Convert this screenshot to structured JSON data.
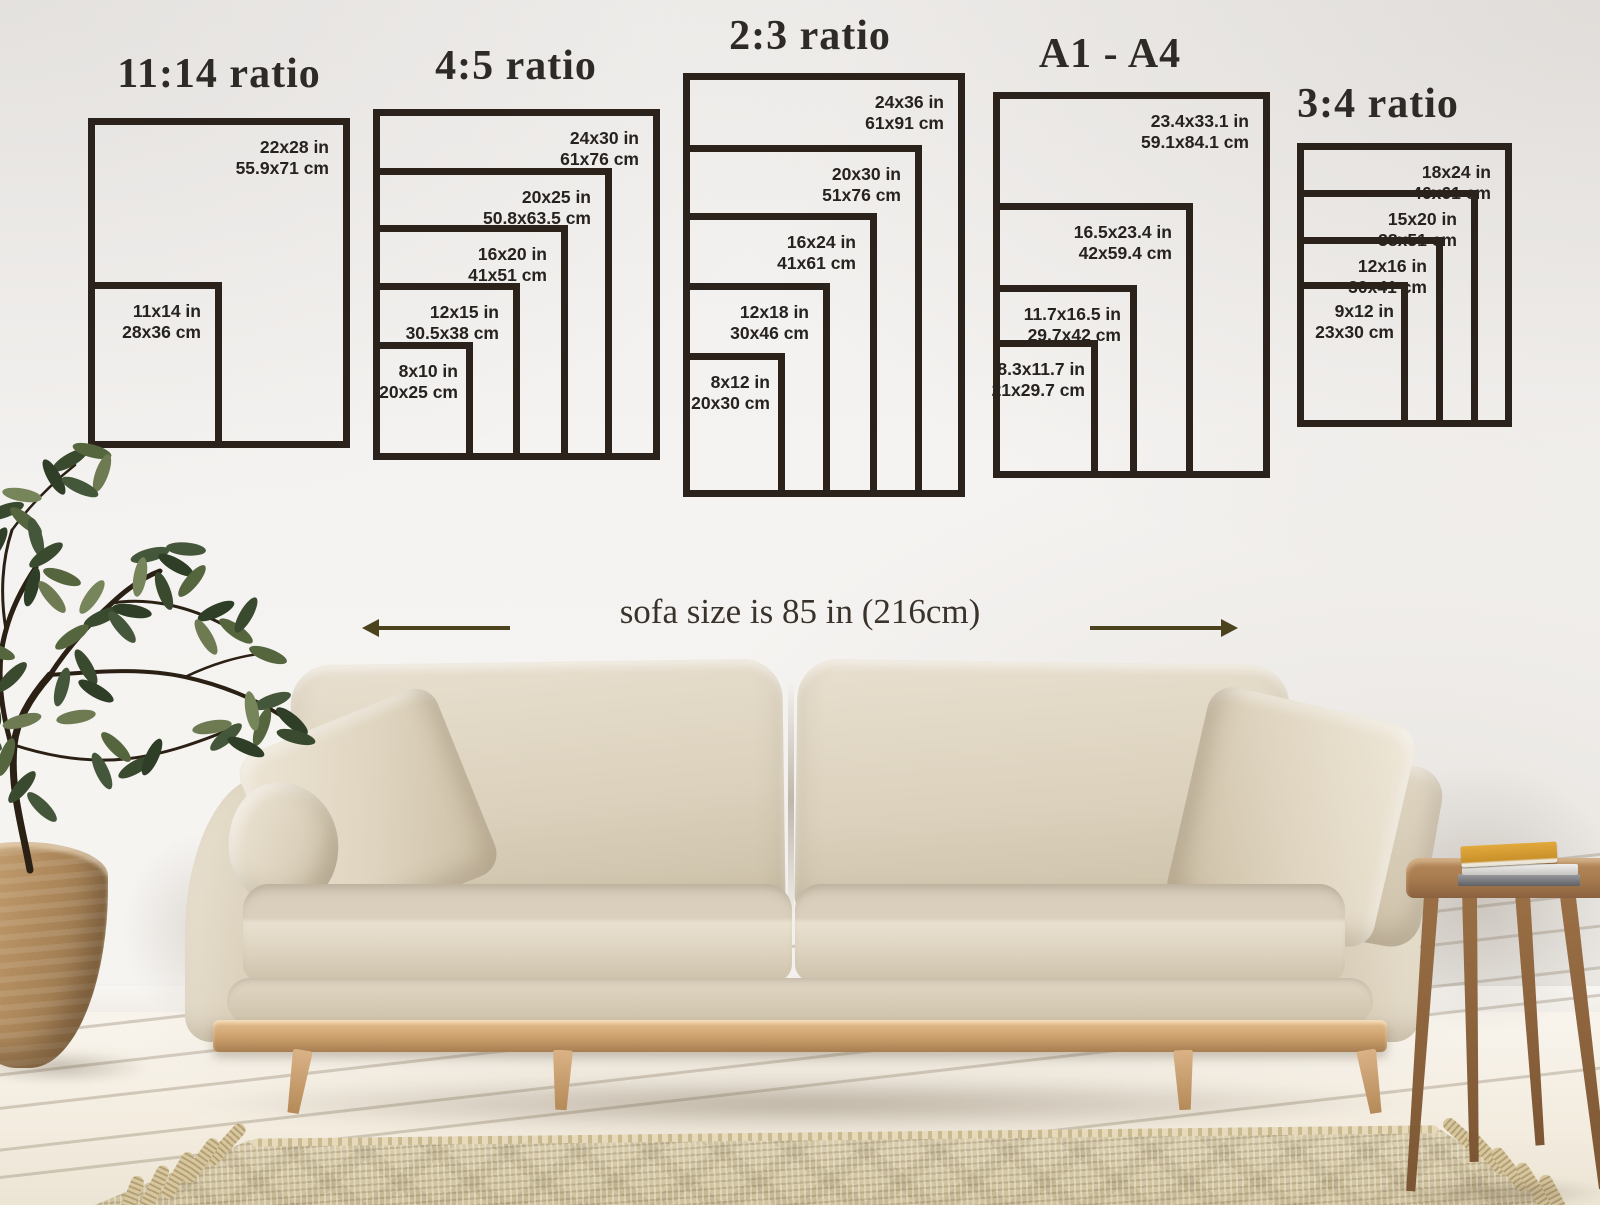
{
  "groups": [
    {
      "title": "11:14 ratio",
      "sizes": [
        {
          "inches": "22x28 in",
          "cm": "55.9x71 cm"
        },
        {
          "inches": "11x14 in",
          "cm": "28x36 cm"
        }
      ]
    },
    {
      "title": "4:5 ratio",
      "sizes": [
        {
          "inches": "24x30 in",
          "cm": "61x76 cm"
        },
        {
          "inches": "20x25 in",
          "cm": "50.8x63.5 cm"
        },
        {
          "inches": "16x20 in",
          "cm": "41x51 cm"
        },
        {
          "inches": "12x15 in",
          "cm": "30.5x38 cm"
        },
        {
          "inches": "8x10 in",
          "cm": "20x25 cm"
        }
      ]
    },
    {
      "title": "2:3 ratio",
      "sizes": [
        {
          "inches": "24x36 in",
          "cm": "61x91 cm"
        },
        {
          "inches": "20x30 in",
          "cm": "51x76 cm"
        },
        {
          "inches": "16x24 in",
          "cm": "41x61 cm"
        },
        {
          "inches": "12x18 in",
          "cm": "30x46 cm"
        },
        {
          "inches": "8x12 in",
          "cm": "20x30 cm"
        }
      ]
    },
    {
      "title": "A1 - A4",
      "sizes": [
        {
          "inches": "23.4x33.1 in",
          "cm": "59.1x84.1 cm"
        },
        {
          "inches": "16.5x23.4 in",
          "cm": "42x59.4 cm"
        },
        {
          "inches": "11.7x16.5 in",
          "cm": "29.7x42 cm"
        },
        {
          "inches": "8.3x11.7 in",
          "cm": "21x29.7 cm"
        }
      ]
    },
    {
      "title": "3:4 ratio",
      "sizes": [
        {
          "inches": "18x24 in",
          "cm": "46x61 cm"
        },
        {
          "inches": "15x20 in",
          "cm": "38x51 cm"
        },
        {
          "inches": "12x16 in",
          "cm": "30x41 cm"
        },
        {
          "inches": "9x12 in",
          "cm": "23x30 cm"
        }
      ]
    }
  ],
  "scene": {
    "sofa_size_label": "sofa size is 85 in (216cm)"
  },
  "colors": {
    "frame_line": "#2b221c",
    "label_text": "#262220",
    "title_text": "#2e2a26",
    "arrow": "#4a431e",
    "wall": "#f4f2f0",
    "floor": "#f3ecdf",
    "sofa_fabric": "#dbd1bc",
    "wood": "#cb9f6c",
    "rug": "#d3c5a2",
    "plant_green": "#44552f",
    "book_yellow": "#d79a2b"
  }
}
